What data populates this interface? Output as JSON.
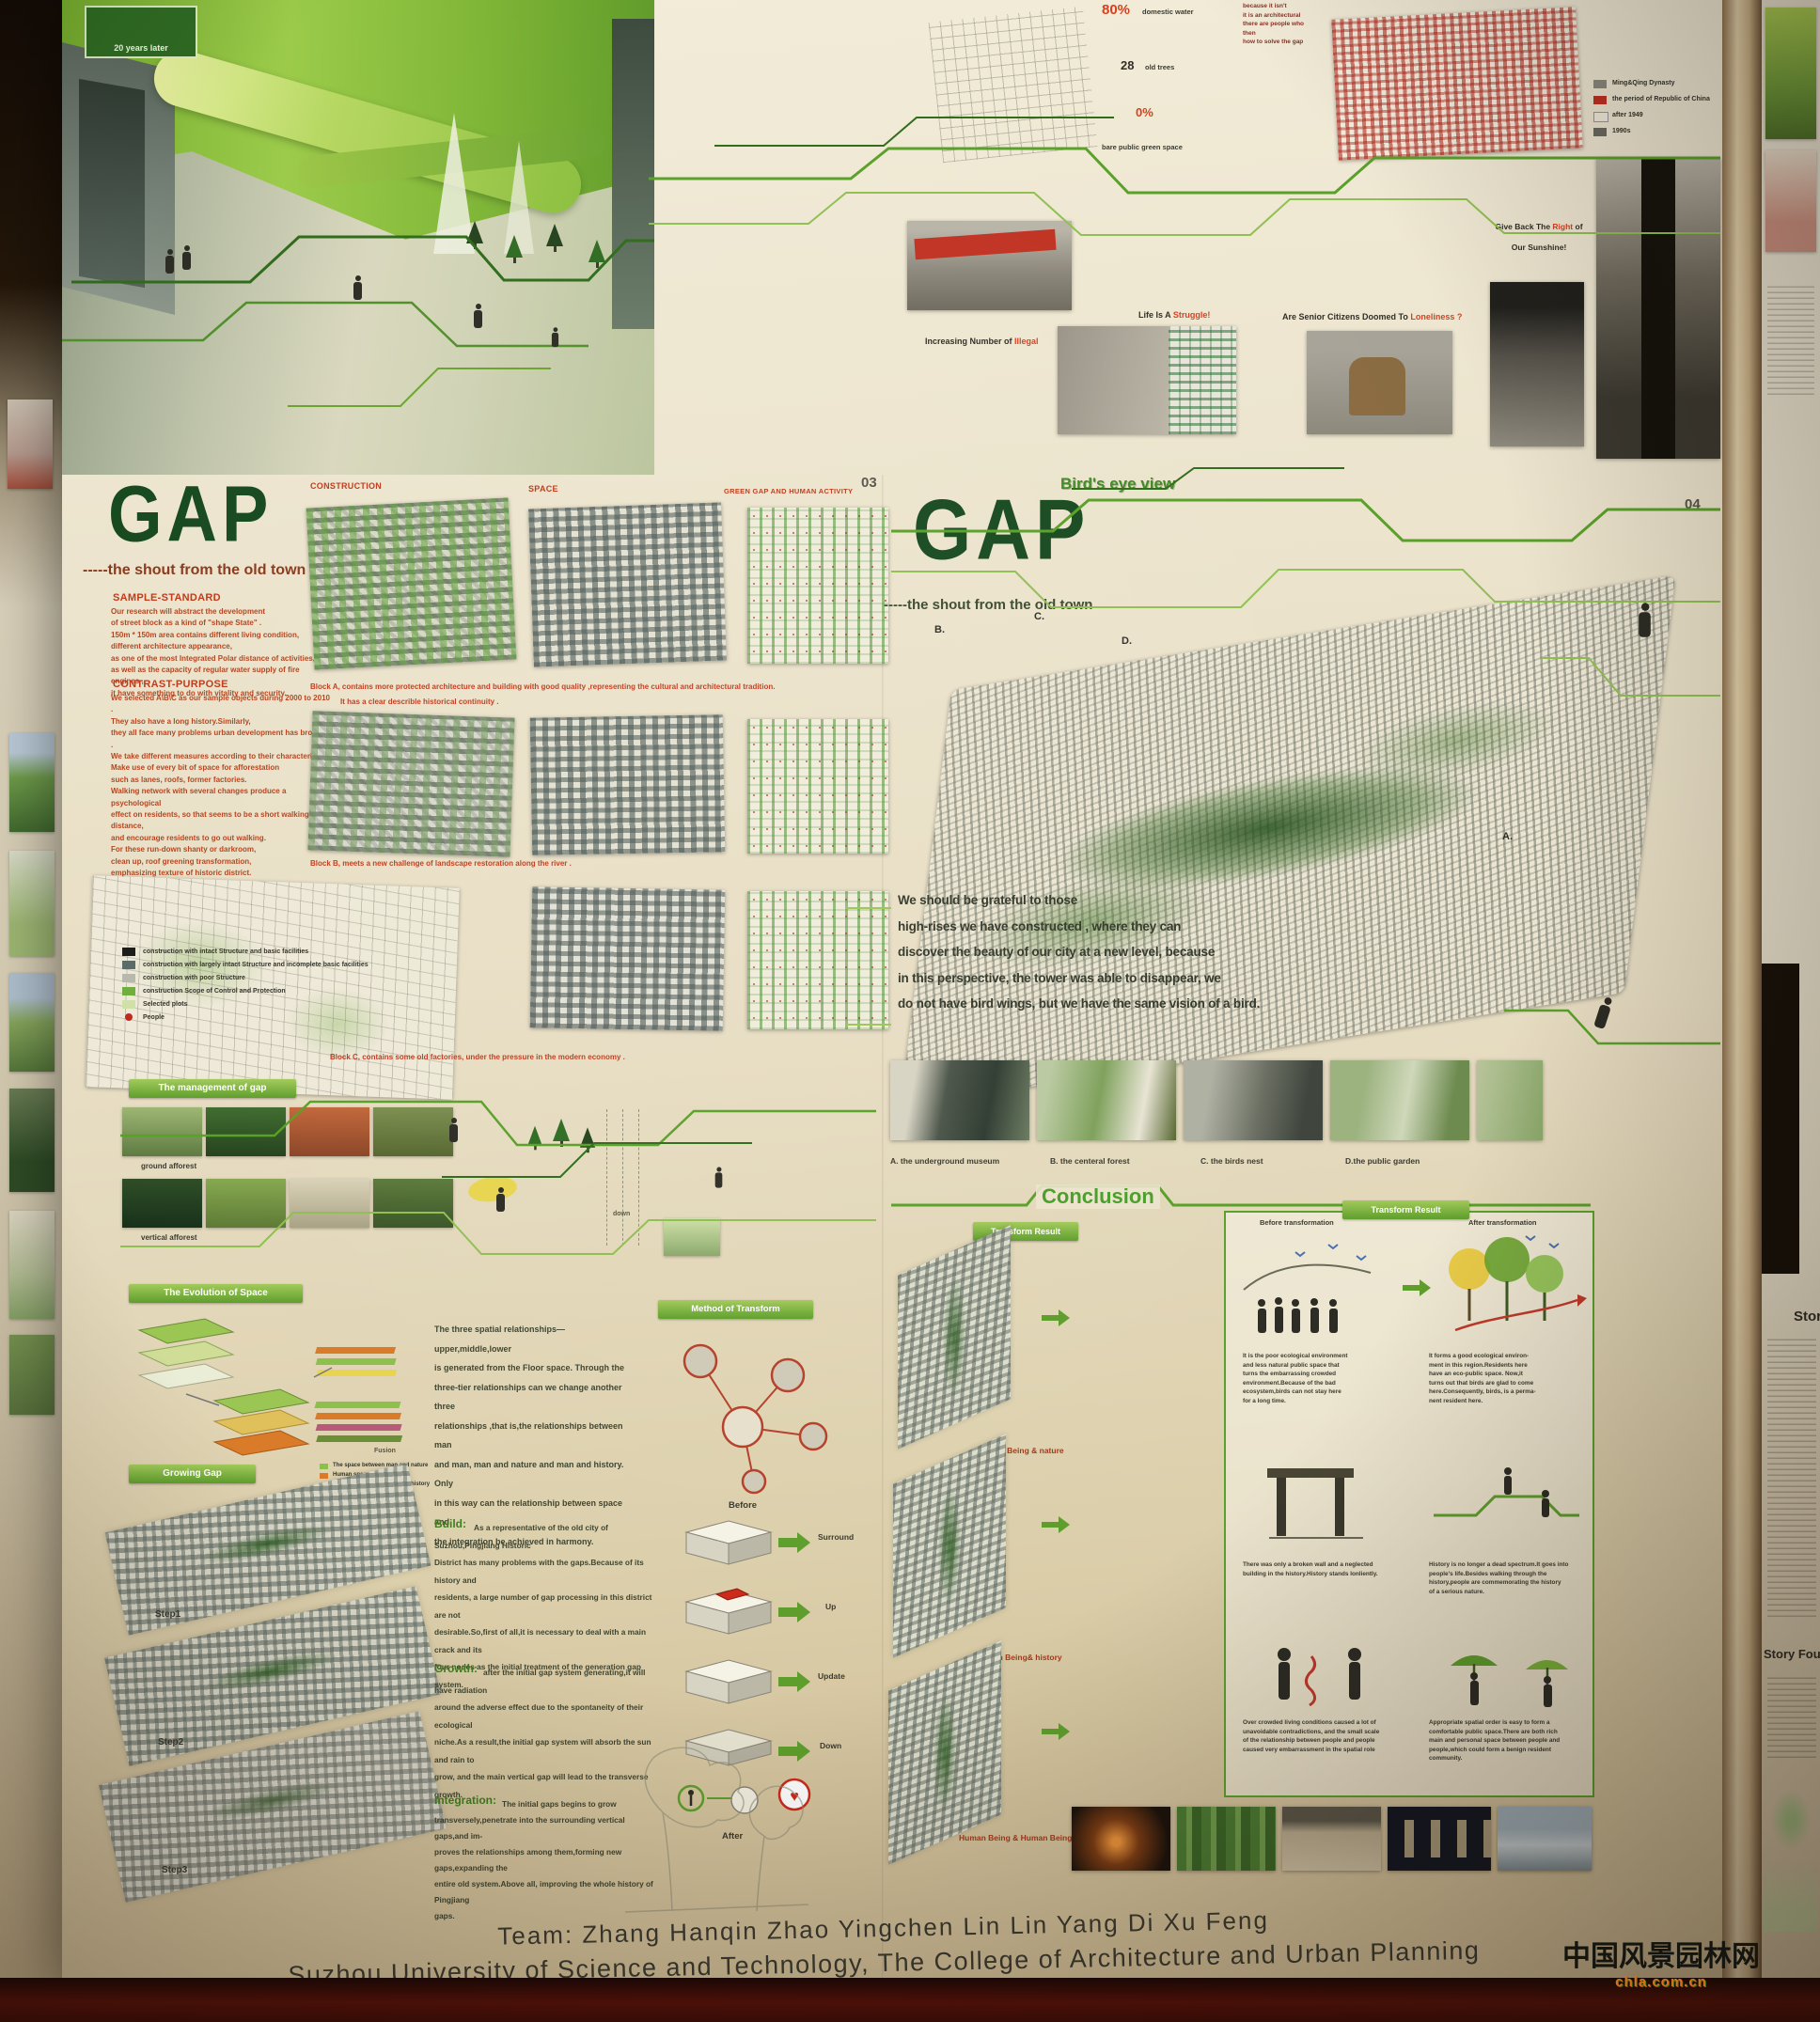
{
  "colors": {
    "paper": "#e9e1c8",
    "title_green": "#17491f",
    "accent_red": "#c03a1a",
    "badge_green": "#6fae3c",
    "circuit_green": "#58a028",
    "maroon_strip": "#551109"
  },
  "hero": {
    "sign": "20 years later"
  },
  "top": {
    "notes": "because it isn't\nit is an architectural\nthere are people who\nthen\nhow to solve the gap",
    "stat1_value": "80%",
    "stat1_label": "domestic water",
    "stat2_value": "28",
    "stat2_label": "old trees",
    "stat3_value": "0%",
    "stat4_label": "bare public green space",
    "map_legend": [
      "Ming&Qing Dynasty",
      "the period of Republic of China",
      "after 1949",
      "1990s"
    ],
    "illegal_pre": "Increasing Number of ",
    "illegal_em": "Illegal",
    "struggle_pre": "Life Is A ",
    "struggle_em": "Struggle!",
    "lonely_pre": "Are Senior Citizens Doomed To ",
    "lonely_em": "Loneliness ?",
    "sunshine_pre": "Give Back The ",
    "sunshine_em": "Right",
    "sunshine_post": " of",
    "sunshine_line2": "Our Sunshine!"
  },
  "panel03": {
    "page": "03",
    "title": "GAP",
    "subtitle": "-----the shout from the old town",
    "sample_standard_h": "SAMPLE-STANDARD",
    "sample_standard": "Our research will abstract the development\nof street block as a kind of \"shape State\" .\n150m * 150m area contains different living condition,\ndifferent architecture appearance,\nas one of the most Integrated Polar distance of activities,\nas well as the capacity of regular water supply of fire engines ,\nit have something to do with vitality and security.",
    "contrast_h": "CONTRAST-PURPOSE",
    "contrast": "We selected A\\B\\C as our sample objects during 2000 to 2010 .\nThey also have a long history.Similarly,\nthey all face many problems urban development has brought .\nWe take different measures according to their characteristics.\nMake use of every bit of space for afforestation\nsuch as lanes, roofs, former factories.\nWalking network with several changes produce a psychological\neffect on residents, so that seems to be a short walking distance,\nand encourage residents to go out walking.\nFor these run-down shanty or darkroom,\nclean up, roof greening transformation,\nemphasizing texture of historic district.\nThe former factories should be\na public building, residential, commercial\nand other duplication of this complex area,\nwhere people feel the contradictions and impact\nof the development and renewal process.",
    "characteristic_h": "SAMPLE-CHARACTERISTIC",
    "headers": [
      "CONSTRUCTION",
      "SPACE",
      "GREEN GAP AND HUMAN ACTIVITY"
    ],
    "cap_a1": "Block A, contains more protected architecture and building with good quality ,representing the cultural and architectural tradition.",
    "cap_a2": "It has a clear describle historical continuity .",
    "cap_b": "Block B, meets a new challenge of landscape restoration along the river .",
    "cap_c": "Block C, contains some old factories, under the pressure in the modern economy .",
    "legend": [
      "construction with intact Structure and basic facilities",
      "construction with largely intact Structure and incomplete basic facilities",
      "construction with poor Structure",
      "construction Scope of Control and Protection",
      "Selected plots",
      "People"
    ],
    "management_badge": "The management of gap",
    "ground": "ground afforest",
    "vertical": "vertical afforest",
    "down": "down",
    "evolution_badge": "The Evolution of Space",
    "evolution": "The three spatial relationships—  upper,middle,lower\nis generated from the Floor space. Through the\nthree-tier relationships can we change another three\nrelationships ,that is,the relationships between man\nand man, man and nature and man and history. Only\nin this way can the relationship between space and\nthe integration be achieved in harmony.",
    "evo_legend": [
      "The space between man and nature",
      "Human space",
      "The space between man and history"
    ],
    "fusion": "Fusion",
    "method_badge": "Method of Transform",
    "before": "Before",
    "after": "After",
    "steps": [
      "Surround",
      "Up",
      "Update",
      "Down"
    ],
    "growing_badge": "Growing Gap",
    "step_labels": [
      "Step1",
      "Step2",
      "Step3"
    ],
    "build_h": "Build:",
    "build": "As a representative of the old city of Suzhou,Pingjiang Historic\nDistrict has many problems with the gaps.Because of its history and\nresidents, a large number of gap processing in this district are not\ndesirable.So,first of all,it is necessary to deal with a main crack and its\nfour nodes as the initial treatment of the generation gap system.",
    "growth_h": "Growth:",
    "growth": "after the initial gap system generating,it will have radiation\naround the adverse effect due to the spontaneity of their ecological\nniche.As a result,the initial gap system will absorb the sun and rain to\ngrow, and the main vertical gap will lead to the transverse growth.",
    "integration_h": "Integration:",
    "integration": "The initial gaps begins to grow\ntransversely,penetrate into the surrounding vertical gaps,and im-\nproves the relationships among them,forming new gaps,expanding the\nentire old system.Above all, improving the whole history of Pingjiang\ngaps."
  },
  "panel04": {
    "page": "04",
    "title": "GAP",
    "eyebrow": "Bird's eye view",
    "subtitle": "-----the shout from the old town",
    "markers": [
      "B.",
      "C.",
      "D.",
      "A."
    ],
    "paragraph": "We should be grateful to those\nhigh-rises we have constructed , where they can\ndiscover the beauty of our city at a new level, because\nin this perspective, the tower was able to disappear, we\ndo not have bird wings, but we have the same vision of a bird.",
    "gallery": [
      "A. the underground  museum",
      "B. the centeral  forest",
      "C. the birds nest",
      "D.the public garden"
    ],
    "conclusion": "Conclusion",
    "transform_badge": "Transform Result",
    "map_labels": [
      "Human Being & nature",
      "Human Being& history",
      "Human Being & Human Being"
    ],
    "box_badge": "Transform Result",
    "col_before": "Before transformation",
    "col_after": "After transformation",
    "r1_before": "It is the poor ecological environment\nand less natural public space that\nturns the embarrassing crowded\nenvironment.Because of the bad\necosystem,birds can not stay here\nfor a long time.",
    "r1_after": "It forms a good ecological environ-\nment in this region.Residents here\nhave an eco-public space. Now,it\nturns out that birds are glad to come\nhere.Consequently, birds, is a perma-\nnent resident here.",
    "r2_before": "There was only a broken wall and a neglected\nbuilding in the history.History stands lonliently.",
    "r2_after": "History is no longer a dead spectrum.It goes into\npeople's life.Besides walking through the\nhistory,people are commemorating the history\nof a serious nature.",
    "r3_before": "Over crowded living conditions caused a lot of\nunavoidable contradictions, and the small scale\nof the relationship between people and people\ncaused very embarrassment in the spatial role",
    "r3_after": "Appropriate spatial order is easy to form a\ncomfortable public space.There are both rich\nmain and personal space between people and\npeople,which could form a benign resident\ncommunity."
  },
  "neighbor_right": {
    "heading1": "Stor",
    "heading2": "Story Four"
  },
  "team": {
    "line1": "Team: Zhang Hanqin   Zhao Yingchen   Lin Lin   Yang Di   Xu Feng",
    "line2": "Suzhou University of Science and Technology, The College of Architecture and Urban Planning"
  },
  "watermark": {
    "line1": "中国风景园林网",
    "line2": "chla.com.cn"
  }
}
